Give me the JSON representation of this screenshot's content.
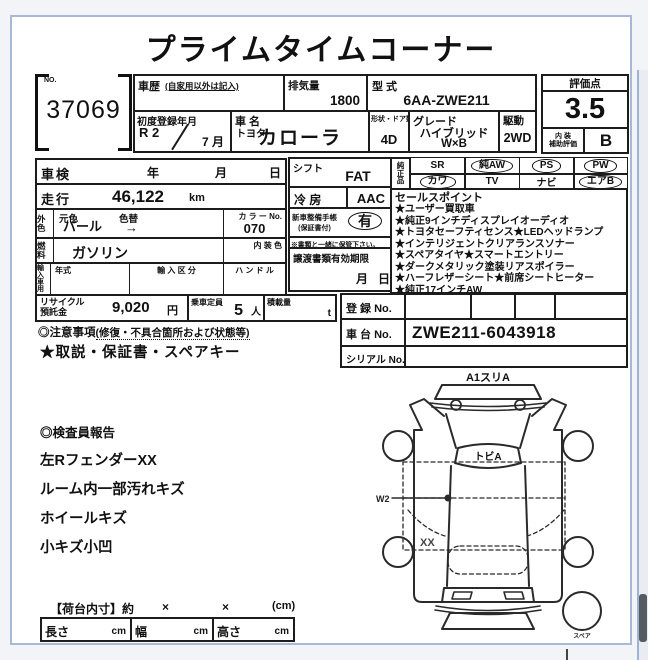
{
  "page": {
    "title": "プライムタイムコーナー"
  },
  "lot": {
    "no_label": "NO.",
    "number": "37069"
  },
  "header": {
    "history_label": "車歴",
    "history_sub": "(自家用以外は記入)",
    "displacement_label": "排気量",
    "displacement_value": "1800",
    "model_label": "型  式",
    "model_value": "6AA-ZWE211",
    "first_reg_label": "初度登録年月",
    "first_reg_year": "R 2",
    "first_reg_month": "7 月",
    "name_label": "車  名",
    "maker": "トヨタ",
    "name_value": "カローラ",
    "body_label": "形状・ドア数",
    "body_value": "4D",
    "grade_label": "グレード",
    "grade_line1": "ハイブリッド",
    "grade_line2": "W×B",
    "drive_label": "駆動",
    "drive_value": "2WD"
  },
  "score": {
    "label": "評価点",
    "value": "3.5",
    "interior_label_1": "内 装",
    "interior_label_2": "補助評価",
    "interior_value": "B"
  },
  "left": {
    "shaken_label": "車検",
    "year_label": "年",
    "month_label": "月",
    "day_label": "日",
    "mileage_label": "走行",
    "mileage_value": "46,122",
    "mileage_unit": "km",
    "ext_label": "外色",
    "base_color_label": "元色",
    "base_color_value": "パール",
    "repaint_label": "色替",
    "repaint_value": "→",
    "color_no_label": "カ ラ ー No.",
    "color_no_value": "070",
    "fuel_label": "燃料",
    "fuel_value": "ガソリン",
    "interior_color_label": "内 装 色",
    "import_label": "輸入車用",
    "import_year_label": "年式",
    "import_class_label": "輸 入 区 分",
    "handle_label": "ハ ン ド ル",
    "recycle_label_1": "リサイクル",
    "recycle_label_2": "預託金",
    "recycle_value": "9,020",
    "recycle_unit": "円",
    "capacity_label": "乗車定員",
    "capacity_value": "5",
    "capacity_unit": "人",
    "load_label": "積載量",
    "load_unit": "t"
  },
  "center": {
    "shift_label": "シフト",
    "shift_value": "FAT",
    "ac_label": "冷  房",
    "ac_value": "AAC",
    "booklet_label_1": "新車整備手帳",
    "booklet_label_2": "(保証書付)",
    "booklet_value": "有",
    "booklet_note": "※書類と一緒に保管下さい。",
    "transfer_label": "譲渡書類有効期限",
    "transfer_month": "月",
    "transfer_day": "日"
  },
  "equipment": {
    "label": "純正品",
    "items": [
      {
        "label": "SR",
        "circled": false
      },
      {
        "label": "純AW",
        "circled": true
      },
      {
        "label": "PS",
        "circled": true
      },
      {
        "label": "PW",
        "circled": true
      },
      {
        "label": "カワ",
        "circled": true
      },
      {
        "label": "TV",
        "circled": false
      },
      {
        "label": "ナビ",
        "circled": false
      },
      {
        "label": "エアB",
        "circled": true
      }
    ]
  },
  "sales": {
    "title": "セールスポイント",
    "lines": [
      "★ユーザー買取車",
      "★純正9インチディスプレイオーディオ",
      "★トヨタセーフティセンス★LEDヘッドランプ",
      "★インテリジェントクリアランスソナー",
      "★スペアタイヤ★スマートエントリー",
      "★ダークメタリック塗装リアスポイラー",
      "★ハーフレザーシート★前席シートヒーター",
      "★純正17インチAW"
    ]
  },
  "registration": {
    "reg_label": "登  録  No.",
    "chassis_label": "車  台  No.",
    "chassis_value": "ZWE211-6043918",
    "serial_label": "シリアル No."
  },
  "caution": {
    "title": "◎注意事項",
    "title_sub": "(修復・不具合箇所および状態等)",
    "line": "★取説・保証書・スペアキー"
  },
  "inspector": {
    "title": "◎検査員報告",
    "lines": [
      "左RフェンダーXX",
      "ルーム内一部汚れキズ",
      "ホイールキズ",
      "小キズ小凹"
    ]
  },
  "diagram": {
    "front_label": "A1スリA",
    "hood_label": "トビA",
    "w2_label": "W2",
    "xx_label": "XX",
    "spare_label": "スペア"
  },
  "cargo": {
    "title": "【荷台内寸】約",
    "times_1": "×",
    "times_2": "×",
    "unit": "(cm)",
    "len_label": "長さ",
    "len_unit": "cm",
    "wid_label": "幅",
    "wid_unit": "cm",
    "hei_label": "高さ",
    "hei_unit": "cm"
  }
}
